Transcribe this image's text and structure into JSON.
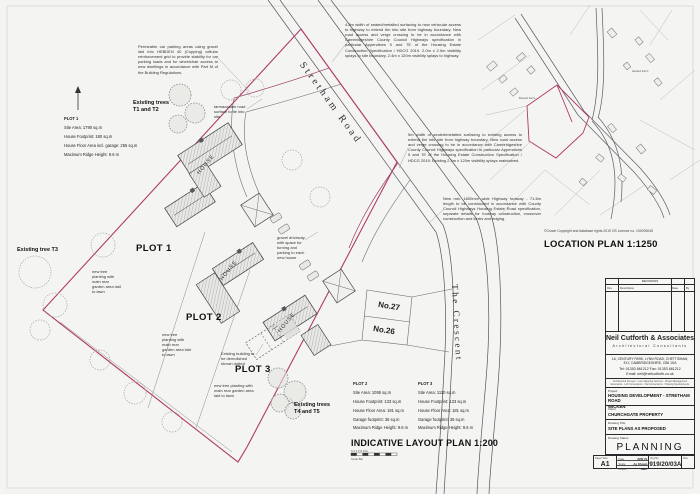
{
  "colors": {
    "boundary": "#b03a66",
    "line": "#54555a",
    "accent_black": "#1c1c1c"
  },
  "main_plan": {
    "title": "INDICATIVE LAYOUT PLAN 1:200",
    "scale_bar_label": "Scale Bar",
    "scale_bar_ticks": "0  2  4  6  8  10m",
    "roads": {
      "stretham": "Stretham Road",
      "crescent": "The Crescent"
    },
    "plot_labels": {
      "p1": "PLOT 1",
      "p2": "PLOT 2",
      "p3": "PLOT 3"
    },
    "house_label": "HOUSE",
    "neighbours": {
      "no27": "No.27",
      "no26": "No.26"
    },
    "trees": {
      "t1": "Existing trees T1 and T2",
      "t3": "Existing tree T3",
      "t45": "Existing trees T4 and T5"
    },
    "notes": {
      "parking": "Permeable car parking areas using gravel laid into HEBDEN 40 (Copping) cellular reinforcement grid to provide stability for car parking loads and for wheelchair access to new dwellings in accordance with Part M of the Building Regulations.",
      "new_access": "4.8m width of sealed/metalled surfacing to new vehicular access to highway to extend 6m into site from highway boundary. New road access and verge crossing to be in accordance with Cambridgeshire County Council Highways specification in particular Appendices 5 and 7E of the Housing Estate Construction Specification / HDCG 2019. 2.0m x 2.0m visibility splays to site boundary. 2.4m x 120m visibility splays to highway.",
      "existing_access": "5m width of sealed/metalled surfacing to existing access to extend 6m into site from highway boundary. New road access and verge crossing to be in accordance with Cambridgeshire County Council Highways specification in particular Appendices 5 and 7E of the Housing Estate Construction Specification / HDCG 2019. Existing 2.4m x 120m visibility splays maintained.",
      "footway": "New min. 1800mm wide Highway footway - 71.6m length to be constructed in accordance with County Council Highways Housing Estate Road specification, separate details for footway construction, crossover construction and kerbs and edging.",
      "tarmac": "tarmacadam road surface to tie into site",
      "driveway": "gravel driveway with space for turning and parking to each new house",
      "tree_planting": "new tree planting with main rear garden area laid to lawn",
      "demolish": "Existing building to be demolished shown dotted"
    },
    "plot1_table": {
      "title": "PLOT 1",
      "rows": [
        "Site Area:  1790 sq.m",
        "House Footprint:  180 sq.m",
        "House Floor Area incl. garage: 255 sq.m",
        "Maximum Ridge Height:  9.6 m"
      ]
    },
    "plot2_table": {
      "title": "PLOT 2",
      "rows": [
        "Site Area:  1095 sq.m",
        "House Footprint:  133 sq.m",
        "House Floor Area: 181 sq.m",
        "Garage footprint:  36 sq.m",
        "Maximum Ridge Height:  9.6 m"
      ]
    },
    "plot3_table": {
      "title": "PLOT 3",
      "rows": [
        "Site Area:  1110 sq.m",
        "House Footprint:  133 sq.m",
        "House Floor Area: 181 sq.m",
        "Garage footprint:  36 sq.m",
        "Maximum Ridge Height:  9.6 m"
      ]
    }
  },
  "location_plan": {
    "title": "LOCATION PLAN 1:1250",
    "copyright": "©Crown Copyright and database rights 2019 OS Licence no. 100093045",
    "labels": {
      "farm1": "Bowels Farm",
      "farm2": "Hazard Farm"
    }
  },
  "title_block": {
    "revisions": {
      "heading": "REVISIONS",
      "columns": [
        "Rev",
        "Description",
        "Date",
        "By"
      ]
    },
    "company": {
      "name": "Neil Cutforth & Associates",
      "tagline": "Architectural Consultants",
      "address1": "1A, CENTURY PARK, LYNN ROAD, CHETTISHAM,",
      "address2": "ELY, CAMBRIDGESHIRE, CB6 1SA",
      "tel": "Tel: 01353 661212   Fax: 01353 661212",
      "email": "Email: neil@neilcutforth.co.uk",
      "services1": "Architectural Surveys · Loss Adjusting Services · Project Management",
      "services2": "Extensions · Loft Conversions · Flat Conversions · Housing Developments"
    },
    "project": {
      "label": "Project",
      "value1": "HOUSING DEVELOPMENT  -  STRETHAM ROAD",
      "value2": "WICKEN"
    },
    "client": {
      "label": "Client",
      "value": "CHURCHGATE PROPERTY"
    },
    "drawing_title": {
      "label": "Drawing Title",
      "value": "SITE PLANS AS PROPOSED"
    },
    "drawing_status": {
      "label": "Drawing Status",
      "value": "PLANNING"
    },
    "info": {
      "paper_size_label": "Paper Size",
      "paper_size": "A1",
      "date_label": "Date",
      "date": "APR 21",
      "scale_label": "Scale",
      "scale": "As Shown",
      "drawn_label": "Drawn",
      "drawn": "NMC",
      "drg_no_label": "Drg No",
      "drg_no": "919/20/03A",
      "rev_label": "Rev"
    }
  }
}
